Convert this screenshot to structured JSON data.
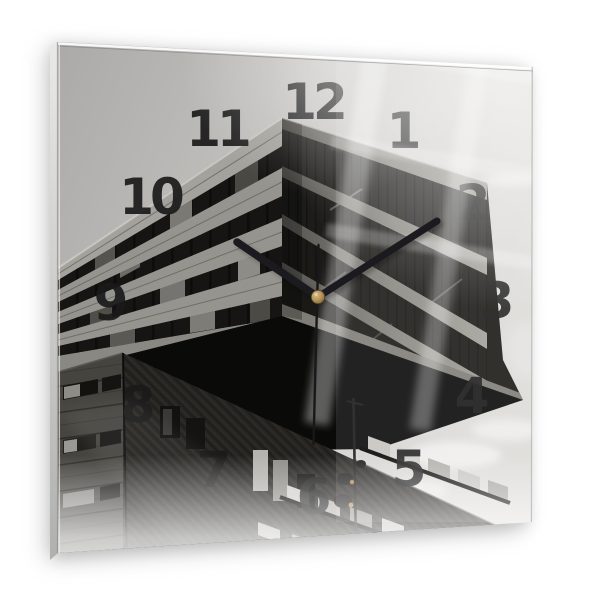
{
  "page": {
    "background_color": "#ffffff"
  },
  "clock": {
    "numerals": [
      "12",
      "1",
      "2",
      "3",
      "4",
      "5",
      "6",
      "7",
      "8",
      "9",
      "10",
      "11"
    ],
    "time_shown": {
      "hours": 10,
      "minutes": 9,
      "seconds": 30
    },
    "colors": {
      "hands": "#1b1b1f",
      "center_pin_brass": "#b2925a",
      "numerals": "#1a1a1a",
      "sky_gray": "#c2c0bd",
      "concrete_gray": "#96948e",
      "shadow_black": "#0a0a09"
    }
  }
}
